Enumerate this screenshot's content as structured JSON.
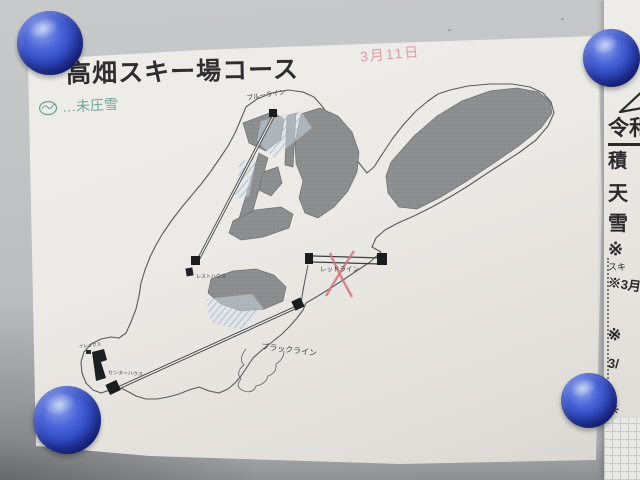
{
  "colors": {
    "wall": "#c1c2c4",
    "paper": "#eceae6",
    "magnet-blue": "#2f49c6",
    "ink": "#2e2e30",
    "map-line": "#595a5c",
    "patch-gray": "#8d8e90",
    "hatch-blue": "#9db3cc",
    "note-pink": "#dd8e98",
    "note-green": "#4f9588",
    "strip-ink": "#2a2a2c"
  },
  "poster": {
    "title": "高畑スキー場コース",
    "date_note": "3月11日",
    "legend_note": "…未圧雪",
    "labels": {
      "blue_line": "ブルーライン",
      "red_line": "レッドライン",
      "black_line": "ブラックライン",
      "rest_house": "レストハウス",
      "center_house": "センターハウス",
      "small_hut": "イレックス"
    }
  },
  "side_note": {
    "heading": "令和",
    "rows": [
      "積",
      "天",
      "雪"
    ],
    "mark1": "※",
    "ski": "スキ",
    "note_march": "※3月",
    "mark2": "※",
    "date_fragment": "3/",
    "flower": "✳"
  }
}
